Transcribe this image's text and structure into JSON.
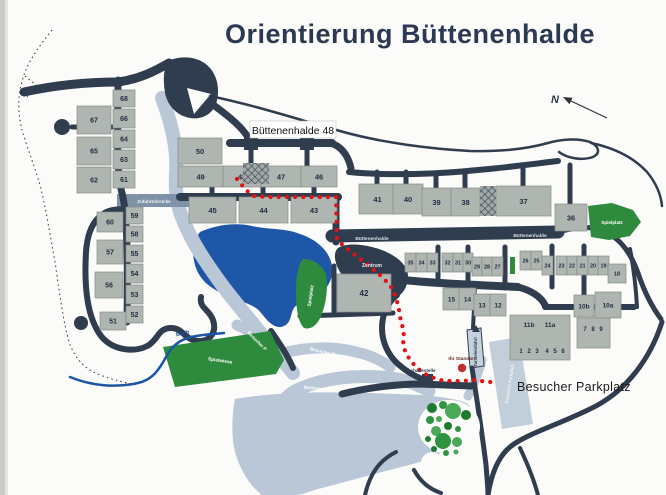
{
  "title": "Orientierung Büttenenhalde",
  "callout": {
    "label": "Büttenenhalde 48"
  },
  "big_label": {
    "text": "Besucher Parkplatz"
  },
  "compass": {
    "label": "N"
  },
  "marker": {
    "label": "Ihr Standort",
    "x": 462,
    "y": 368
  },
  "colors": {
    "title": "#2b3a52",
    "road_dark": "#2f3d4f",
    "road_light": "#b9c7d6",
    "bridge_band": "#7e93a8",
    "building": "#afb6b2",
    "building_stroke": "#858c88",
    "number": "#232f42",
    "pond": "#1f57a8",
    "green": "#2e8b3d",
    "route": "#e31212",
    "marker": "#c03030",
    "paper": "#fbfbf9"
  },
  "buildings": [
    [
      "68",
      113,
      90,
      22,
      17,
      7
    ],
    [
      "66",
      113,
      109,
      22,
      19,
      7
    ],
    [
      "64",
      113,
      130,
      22,
      18,
      7
    ],
    [
      "63",
      113,
      150,
      22,
      19,
      7
    ],
    [
      "61",
      113,
      171,
      22,
      17,
      7
    ],
    [
      "67",
      77,
      106,
      34,
      28,
      7
    ],
    [
      "65",
      77,
      137,
      34,
      28,
      7
    ],
    [
      "62",
      77,
      167,
      34,
      26,
      7
    ],
    [
      "60",
      97,
      212,
      26,
      20,
      7
    ],
    [
      "57",
      97,
      240,
      26,
      24,
      7
    ],
    [
      "56",
      95,
      272,
      28,
      26,
      7
    ],
    [
      "51",
      100,
      312,
      26,
      18,
      7
    ],
    [
      "59",
      126,
      207,
      17,
      17,
      7
    ],
    [
      "58",
      126,
      226,
      17,
      16,
      7
    ],
    [
      "55",
      126,
      245,
      17,
      17,
      7
    ],
    [
      "54",
      126,
      264,
      17,
      19,
      7
    ],
    [
      "53",
      126,
      285,
      17,
      19,
      7
    ],
    [
      "52",
      126,
      306,
      17,
      17,
      7
    ],
    [
      "50",
      178,
      138,
      44,
      26,
      7.5
    ],
    [
      "49",
      178,
      166,
      45,
      21,
      7.5
    ],
    [
      "48",
      223,
      166,
      38,
      21,
      7.5
    ],
    [
      "47",
      261,
      166,
      40,
      21,
      7.5
    ],
    [
      "46",
      301,
      166,
      36,
      21,
      7.5
    ],
    [
      "45",
      189,
      197,
      47,
      26,
      7.5
    ],
    [
      "44",
      239,
      197,
      49,
      26,
      7.5
    ],
    [
      "43",
      291,
      197,
      46,
      26,
      7.5
    ],
    [
      "41",
      359,
      184,
      37,
      30,
      7.5
    ],
    [
      "40",
      393,
      184,
      30,
      30,
      7.5
    ],
    [
      "39",
      422,
      188,
      29,
      28,
      7.5
    ],
    [
      "38",
      451,
      188,
      29,
      28,
      7.5
    ],
    [
      "37",
      496,
      186,
      55,
      30,
      7.5
    ],
    [
      "36",
      555,
      204,
      32,
      27,
      7.5
    ],
    [
      "42",
      337,
      274,
      54,
      38,
      8
    ],
    [
      "35",
      405,
      253,
      11,
      19,
      5.5
    ],
    [
      "34",
      416,
      253,
      11,
      19,
      5.5
    ],
    [
      "33",
      427,
      253,
      11,
      19,
      5.5
    ],
    [
      "32",
      442,
      253,
      11,
      19,
      5.5
    ],
    [
      "31",
      453,
      253,
      10,
      19,
      5.5
    ],
    [
      "30",
      463,
      253,
      10,
      19,
      5.5
    ],
    [
      "29",
      472,
      257,
      10,
      19,
      5.5
    ],
    [
      "28",
      482,
      257,
      10,
      19,
      5.5
    ],
    [
      "27",
      492,
      257,
      11,
      19,
      5.5
    ],
    [
      "26",
      520,
      251,
      11,
      19,
      5.5
    ],
    [
      "25",
      531,
      251,
      11,
      19,
      5.5
    ],
    [
      "24",
      542,
      256,
      11,
      19,
      5.5
    ],
    [
      "23",
      556,
      256,
      11,
      19,
      5.5
    ],
    [
      "22",
      567,
      256,
      10,
      19,
      5.5
    ],
    [
      "21",
      577,
      256,
      11,
      19,
      5.5
    ],
    [
      "20",
      588,
      256,
      10,
      19,
      5.5
    ],
    [
      "19",
      598,
      256,
      11,
      19,
      5.5
    ],
    [
      "18",
      608,
      264,
      18,
      19,
      5.5
    ],
    [
      "15",
      443,
      288,
      17,
      22,
      6.5
    ],
    [
      "14",
      459,
      288,
      17,
      22,
      6.5
    ],
    [
      "13",
      474,
      294,
      16,
      22,
      6.5
    ],
    [
      "12",
      490,
      294,
      16,
      22,
      6.5
    ],
    [
      "10b",
      574,
      295,
      20,
      22,
      6.5
    ],
    [
      "10a",
      595,
      292,
      26,
      26,
      6.5
    ],
    [
      "",
      510,
      315,
      60,
      45,
      6
    ],
    [
      "",
      577,
      318,
      33,
      30,
      6
    ]
  ],
  "extra_labels": [
    {
      "t": "11b",
      "x": 529,
      "y": 327,
      "fs": 6.5
    },
    {
      "t": "11a",
      "x": 550,
      "y": 327,
      "fs": 6.5
    },
    {
      "t": "1",
      "x": 521,
      "y": 353,
      "fs": 6
    },
    {
      "t": "2",
      "x": 529,
      "y": 353,
      "fs": 6
    },
    {
      "t": "3",
      "x": 537,
      "y": 353,
      "fs": 6
    },
    {
      "t": "4",
      "x": 547,
      "y": 353,
      "fs": 6
    },
    {
      "t": "5",
      "x": 555,
      "y": 353,
      "fs": 6
    },
    {
      "t": "6",
      "x": 563,
      "y": 353,
      "fs": 6
    },
    {
      "t": "7",
      "x": 585,
      "y": 331,
      "fs": 6
    },
    {
      "t": "8",
      "x": 593,
      "y": 331,
      "fs": 6
    },
    {
      "t": "9",
      "x": 601,
      "y": 331,
      "fs": 6
    }
  ],
  "map_labels": [
    {
      "t": "Zentrum",
      "x": 372,
      "y": 267,
      "fs": 5,
      "rot": 0,
      "fill": "#e8ecf0"
    },
    {
      "t": "Büttenenhalde",
      "x": 372,
      "y": 240,
      "fs": 4.8,
      "rot": 0,
      "fill": "#d9dfe6"
    },
    {
      "t": "Büttenenhalde",
      "x": 530,
      "y": 237,
      "fs": 4.8,
      "rot": 0,
      "fill": "#d9dfe6"
    },
    {
      "t": "Zufahrtsbrücke",
      "x": 154,
      "y": 203,
      "fs": 4.6,
      "rot": 0,
      "fill": "#eef2f5"
    },
    {
      "t": "Bach",
      "x": 183,
      "y": 335,
      "fs": 5.5,
      "rot": -12,
      "fill": "#1d4f9e"
    },
    {
      "t": "Besucher P",
      "x": 256,
      "y": 342,
      "fs": 4.6,
      "rot": 45,
      "fill": "#ffffff"
    },
    {
      "t": "Besucher P",
      "x": 322,
      "y": 353,
      "fs": 4.6,
      "rot": 13,
      "fill": "#ffffff"
    },
    {
      "t": "Büttenenring",
      "x": 318,
      "y": 390,
      "fs": 4.6,
      "rot": 5,
      "fill": "#ffffff"
    },
    {
      "t": "Spielwiese",
      "x": 220,
      "y": 362,
      "fs": 4.8,
      "rot": 8,
      "fill": "#ffffff"
    },
    {
      "t": "Spielplatz",
      "x": 312,
      "y": 296,
      "fs": 4.6,
      "rot": -82,
      "fill": "#ffffff"
    },
    {
      "t": "Spielplatz",
      "x": 612,
      "y": 224,
      "fs": 4.6,
      "rot": 0,
      "fill": "#ffffff"
    },
    {
      "t": "Tunneleinfahrt",
      "x": 477,
      "y": 352,
      "fs": 4.3,
      "rot": -90,
      "fill": "#2f3d4f"
    },
    {
      "t": "Besucher Parkplatz",
      "x": 511,
      "y": 384,
      "fs": 4.3,
      "rot": -81,
      "fill": "#eef2f5"
    },
    {
      "t": "Bushaltestelle",
      "x": 420,
      "y": 372,
      "fs": 4.6,
      "rot": 0,
      "fill": "#2f3d4f"
    },
    {
      "t": "Ihr Standort",
      "x": 462,
      "y": 360,
      "fs": 4.8,
      "rot": 0,
      "fill": "#5c2d1d"
    }
  ],
  "route": {
    "dot_spacing": 8.2,
    "dot_radius": 2.1,
    "waypoints": [
      [
        237,
        179
      ],
      [
        245,
        189
      ],
      [
        253,
        196
      ],
      [
        268,
        197
      ],
      [
        336,
        197
      ],
      [
        337,
        240
      ],
      [
        350,
        251
      ],
      [
        364,
        262
      ],
      [
        378,
        273
      ],
      [
        390,
        285
      ],
      [
        396,
        297
      ],
      [
        399,
        310
      ],
      [
        401,
        322
      ],
      [
        404,
        331
      ],
      [
        403,
        341
      ],
      [
        405,
        351
      ],
      [
        410,
        360
      ],
      [
        417,
        368
      ],
      [
        425,
        374
      ],
      [
        434,
        378
      ],
      [
        444,
        381
      ],
      [
        454,
        381
      ],
      [
        463,
        381
      ],
      [
        472,
        380
      ],
      [
        481,
        381
      ],
      [
        490,
        382
      ],
      [
        497,
        383
      ]
    ]
  },
  "trees": [
    [
      432,
      408,
      5
    ],
    [
      443,
      405,
      4
    ],
    [
      453,
      411,
      8
    ],
    [
      466,
      415,
      5
    ],
    [
      430,
      420,
      4
    ],
    [
      439,
      419,
      3
    ],
    [
      448,
      426,
      4
    ],
    [
      458,
      429,
      3
    ],
    [
      436,
      431,
      5
    ],
    [
      428,
      439,
      3
    ],
    [
      443,
      441,
      8
    ],
    [
      457,
      442,
      5
    ],
    [
      434,
      449,
      3
    ],
    [
      446,
      453,
      3
    ],
    [
      456,
      452,
      2.5
    ]
  ]
}
